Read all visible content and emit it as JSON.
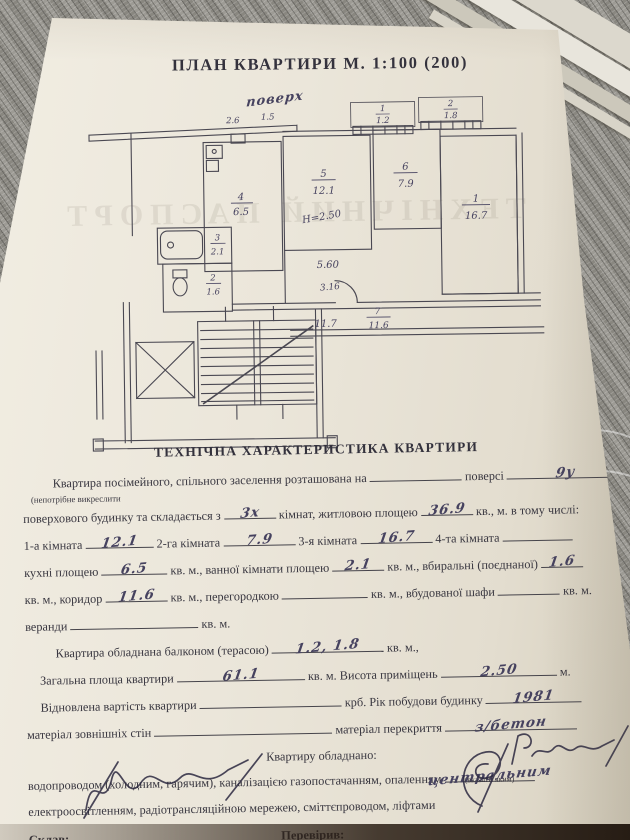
{
  "plan": {
    "title": "ПЛАН КВАРТИРИ М. 1:100 (200)",
    "handwritten_note_top": "поверх",
    "watermark": "ТЕХНІЧНИЙ ПАСПОРТ",
    "height_note": "Н=2.50",
    "rooms": [
      {
        "num": "4",
        "area": "6.5"
      },
      {
        "num": "5",
        "area": "12.1"
      },
      {
        "num": "6",
        "area": "7.9"
      },
      {
        "num": "1",
        "area": "16.7"
      },
      {
        "num": "3",
        "area": "2.1"
      },
      {
        "num": "2",
        "area": "1.6"
      },
      {
        "num": "7",
        "area": "11.6"
      }
    ],
    "balconies": [
      {
        "num": "1",
        "area": "1.2"
      },
      {
        "num": "2",
        "area": "1.8"
      }
    ],
    "dims": {
      "room5_width": "5.60",
      "corridor_width": "3.16",
      "bottom": "11.7",
      "top_a": "2.6",
      "top_b": "1.5"
    }
  },
  "form": {
    "heading": "ТЕХНІЧНА ХАРАКТЕРИСТИКА КВАРТИРИ",
    "l1_pre": "Квартира посімейного, спільного заселення розташована на",
    "l1_mid": "поверсі",
    "l1_val": "9у",
    "l1_note": "(непотрібне викреслити",
    "l2_pre": "поверхового будинку та складається з",
    "l2_v1": "3х",
    "l2_mid": "кімнат, житловою площею",
    "l2_v2": "36.9",
    "l2_post": "кв., м. в тому числі:",
    "l3_a": "1-а кімната",
    "l3_av": "12.1",
    "l3_b": "2-га кімната",
    "l3_bv": "7.9",
    "l3_c": "3-я кімната",
    "l3_cv": "16.7",
    "l3_d": "4-та кімната",
    "l3_dv": "",
    "l4_a": "кухні площею",
    "l4_av": "6.5",
    "l4_b": "кв. м., ванної кімнати площею",
    "l4_bv": "2.1",
    "l4_c": "кв. м., вбиральні (поєднаної)",
    "l4_cv": "1.6",
    "l5_a": "кв. м., коридор",
    "l5_av": "11.6",
    "l5_b": "кв. м., перегородкою",
    "l5_bv": "",
    "l5_c": "кв. м., вбудованої шафи",
    "l5_cv": "",
    "l5_d": "кв. м.",
    "l6_a": "веранди",
    "l6_av": "",
    "l6_b": "кв. м.",
    "l7_a": "Квартира обладнана балконом (терасою)",
    "l7_av": "1.2, 1.8",
    "l7_b": "кв. м.,",
    "l8_a": "Загальна площа квартири",
    "l8_av": "61.1",
    "l8_b": "кв. м. Висота приміщень",
    "l8_bv": "2.50",
    "l8_c": "м.",
    "l9_a": "Відновлена вартість квартири",
    "l9_av": "",
    "l9_b": "крб. Рік побудови будинку",
    "l9_bv": "1981",
    "l10_a": "матеріал зовнішніх стін",
    "l10_av": "",
    "l10_b": "матеріал перекриття",
    "l10_bv": "з/бетон",
    "l11": "Квартиру обладнано:",
    "l12_a": "водопроводом (холодним, гарячим), каналізацією газопостачанням, опаленням",
    "l12_av": "центральним",
    "l12_note": "(вказати яким)",
    "l13": "електроосвітленням, радіотрансляційною мережею, сміттєпроводом, ліфтами",
    "sklav_label": "Склав:",
    "perevyriv_label": "Перевірив:",
    "footer": "Зам. 75—100"
  }
}
